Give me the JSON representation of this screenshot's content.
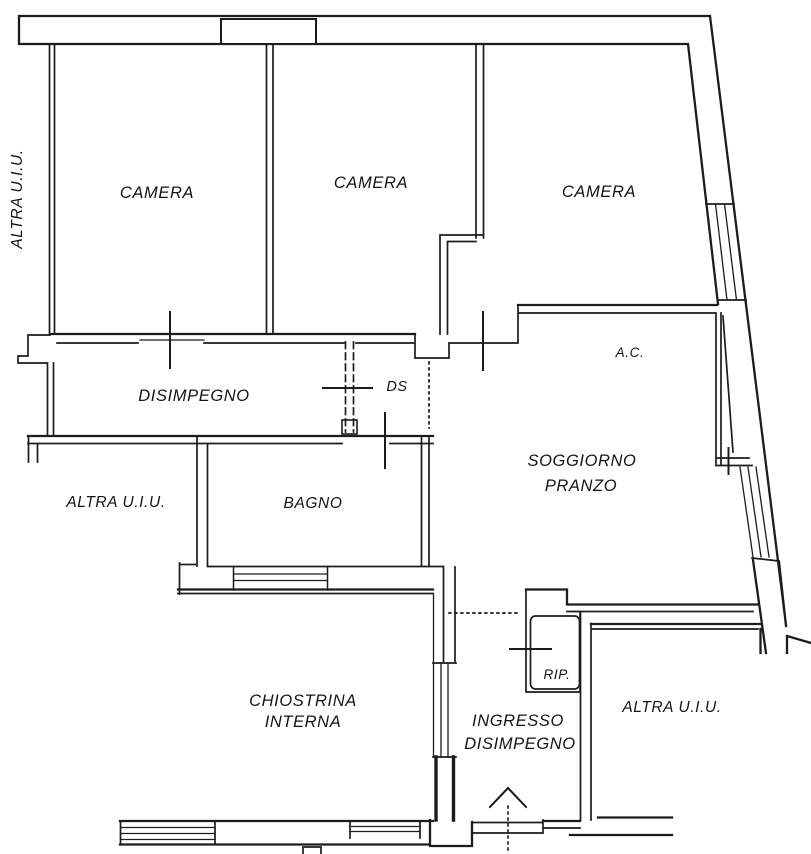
{
  "document": {
    "kind": "apartment floor plan (scanned planimetria)",
    "colors": {
      "line": "#1c1c1c",
      "background": "#ffffff",
      "text": "#141414"
    }
  },
  "labels": {
    "camera_1": "CAMERA",
    "camera_2": "CAMERA",
    "camera_3": "CAMERA",
    "altra_uiu_left": "ALTRA U.I.U.",
    "altra_uiu_mid": "ALTRA U.I.U.",
    "altra_uiu_bottom_right": "ALTRA U.I.U.",
    "disimpegno": "DISIMPEGNO",
    "ds": "DS",
    "ac": "A.C.",
    "soggiorno_line_1": "SOGGIORNO",
    "soggiorno_line_2": "PRANZO",
    "bagno": "BAGNO",
    "chiostrina_line_1": "CHIOSTRINA",
    "chiostrina_line_2": "INTERNA",
    "rip": "RIP.",
    "ingresso_line_1": "INGRESSO",
    "ingresso_line_2": "DISIMPEGNO"
  }
}
